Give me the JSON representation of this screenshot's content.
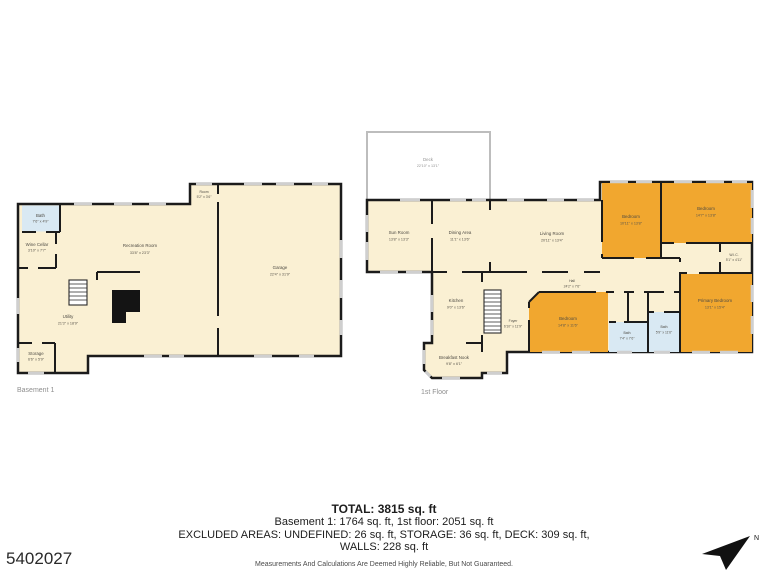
{
  "photo_id": "5402027",
  "compass": {
    "label": "N"
  },
  "colors": {
    "room_fill": "#FAF0D3",
    "bedroom_fill": "#F1A72F",
    "bath_fill": "#D9E9F3",
    "wall": "#1B1B1B",
    "deck_border": "#BDBDBD",
    "window": "#CFCFCF"
  },
  "floors": [
    {
      "label": "Basement 1",
      "rooms": [
        {
          "name": "Bath",
          "dims": "7'6\" x 4'9\""
        },
        {
          "name": "Wine Cellar",
          "dims": "3'10\" x 7'7\""
        },
        {
          "name": "Recreation Room",
          "dims": "33'8\" x 23'3\""
        },
        {
          "name": "Utility",
          "dims": "21'3\" x 18'9\""
        },
        {
          "name": "Storage",
          "dims": "6'6\" x 5'9\""
        },
        {
          "name": "Room",
          "dims": "5'2\" x 3'6\""
        },
        {
          "name": "Garage",
          "dims": "22'4\" x 31'9\""
        }
      ]
    },
    {
      "label": "1st Floor",
      "rooms": [
        {
          "name": "Deck",
          "dims": "22'10\" x 13'1\""
        },
        {
          "name": "Sun Room",
          "dims": "13'8\" x 13'3\""
        },
        {
          "name": "Dining Area",
          "dims": "11'1\" x 13'6\""
        },
        {
          "name": "Living Room",
          "dims": "20'11\" x 13'4\""
        },
        {
          "name": "Bedroom",
          "dims": "10'11\" x 13'8\""
        },
        {
          "name": "Bedroom",
          "dims": "14'7\" x 13'8\""
        },
        {
          "name": "W.I.C.",
          "dims": "5'1\" x 4'11\""
        },
        {
          "name": "Hall",
          "dims": "24'2\" x 7'6\""
        },
        {
          "name": "Kitchen",
          "dims": "9'0\" x 13'6\""
        },
        {
          "name": "Foyer",
          "dims": "6'10\" x 11'9\""
        },
        {
          "name": "Breakfast Nook",
          "dims": "9'8\" x 6'1\""
        },
        {
          "name": "Bedroom",
          "dims": "14'8\" x 11'6\""
        },
        {
          "name": "Bath",
          "dims": "7'4\" x 7'6\""
        },
        {
          "name": "Bath",
          "dims": "5'9\" x 11'6\""
        },
        {
          "name": "Primary Bedroom",
          "dims": "13'1\" x 15'4\""
        }
      ]
    }
  ],
  "summary": {
    "total": "TOTAL: 3815 sq. ft",
    "floors_line": "Basement 1: 1764 sq. ft, 1st floor: 2051 sq. ft",
    "excluded_line": "EXCLUDED AREAS: UNDEFINED: 26 sq. ft, STORAGE: 36 sq. ft, DECK: 309 sq. ft,",
    "walls_line": "WALLS: 228 sq. ft",
    "disclaimer": "Measurements And Calculations Are Deemed Highly Reliable, But Not Guaranteed."
  }
}
